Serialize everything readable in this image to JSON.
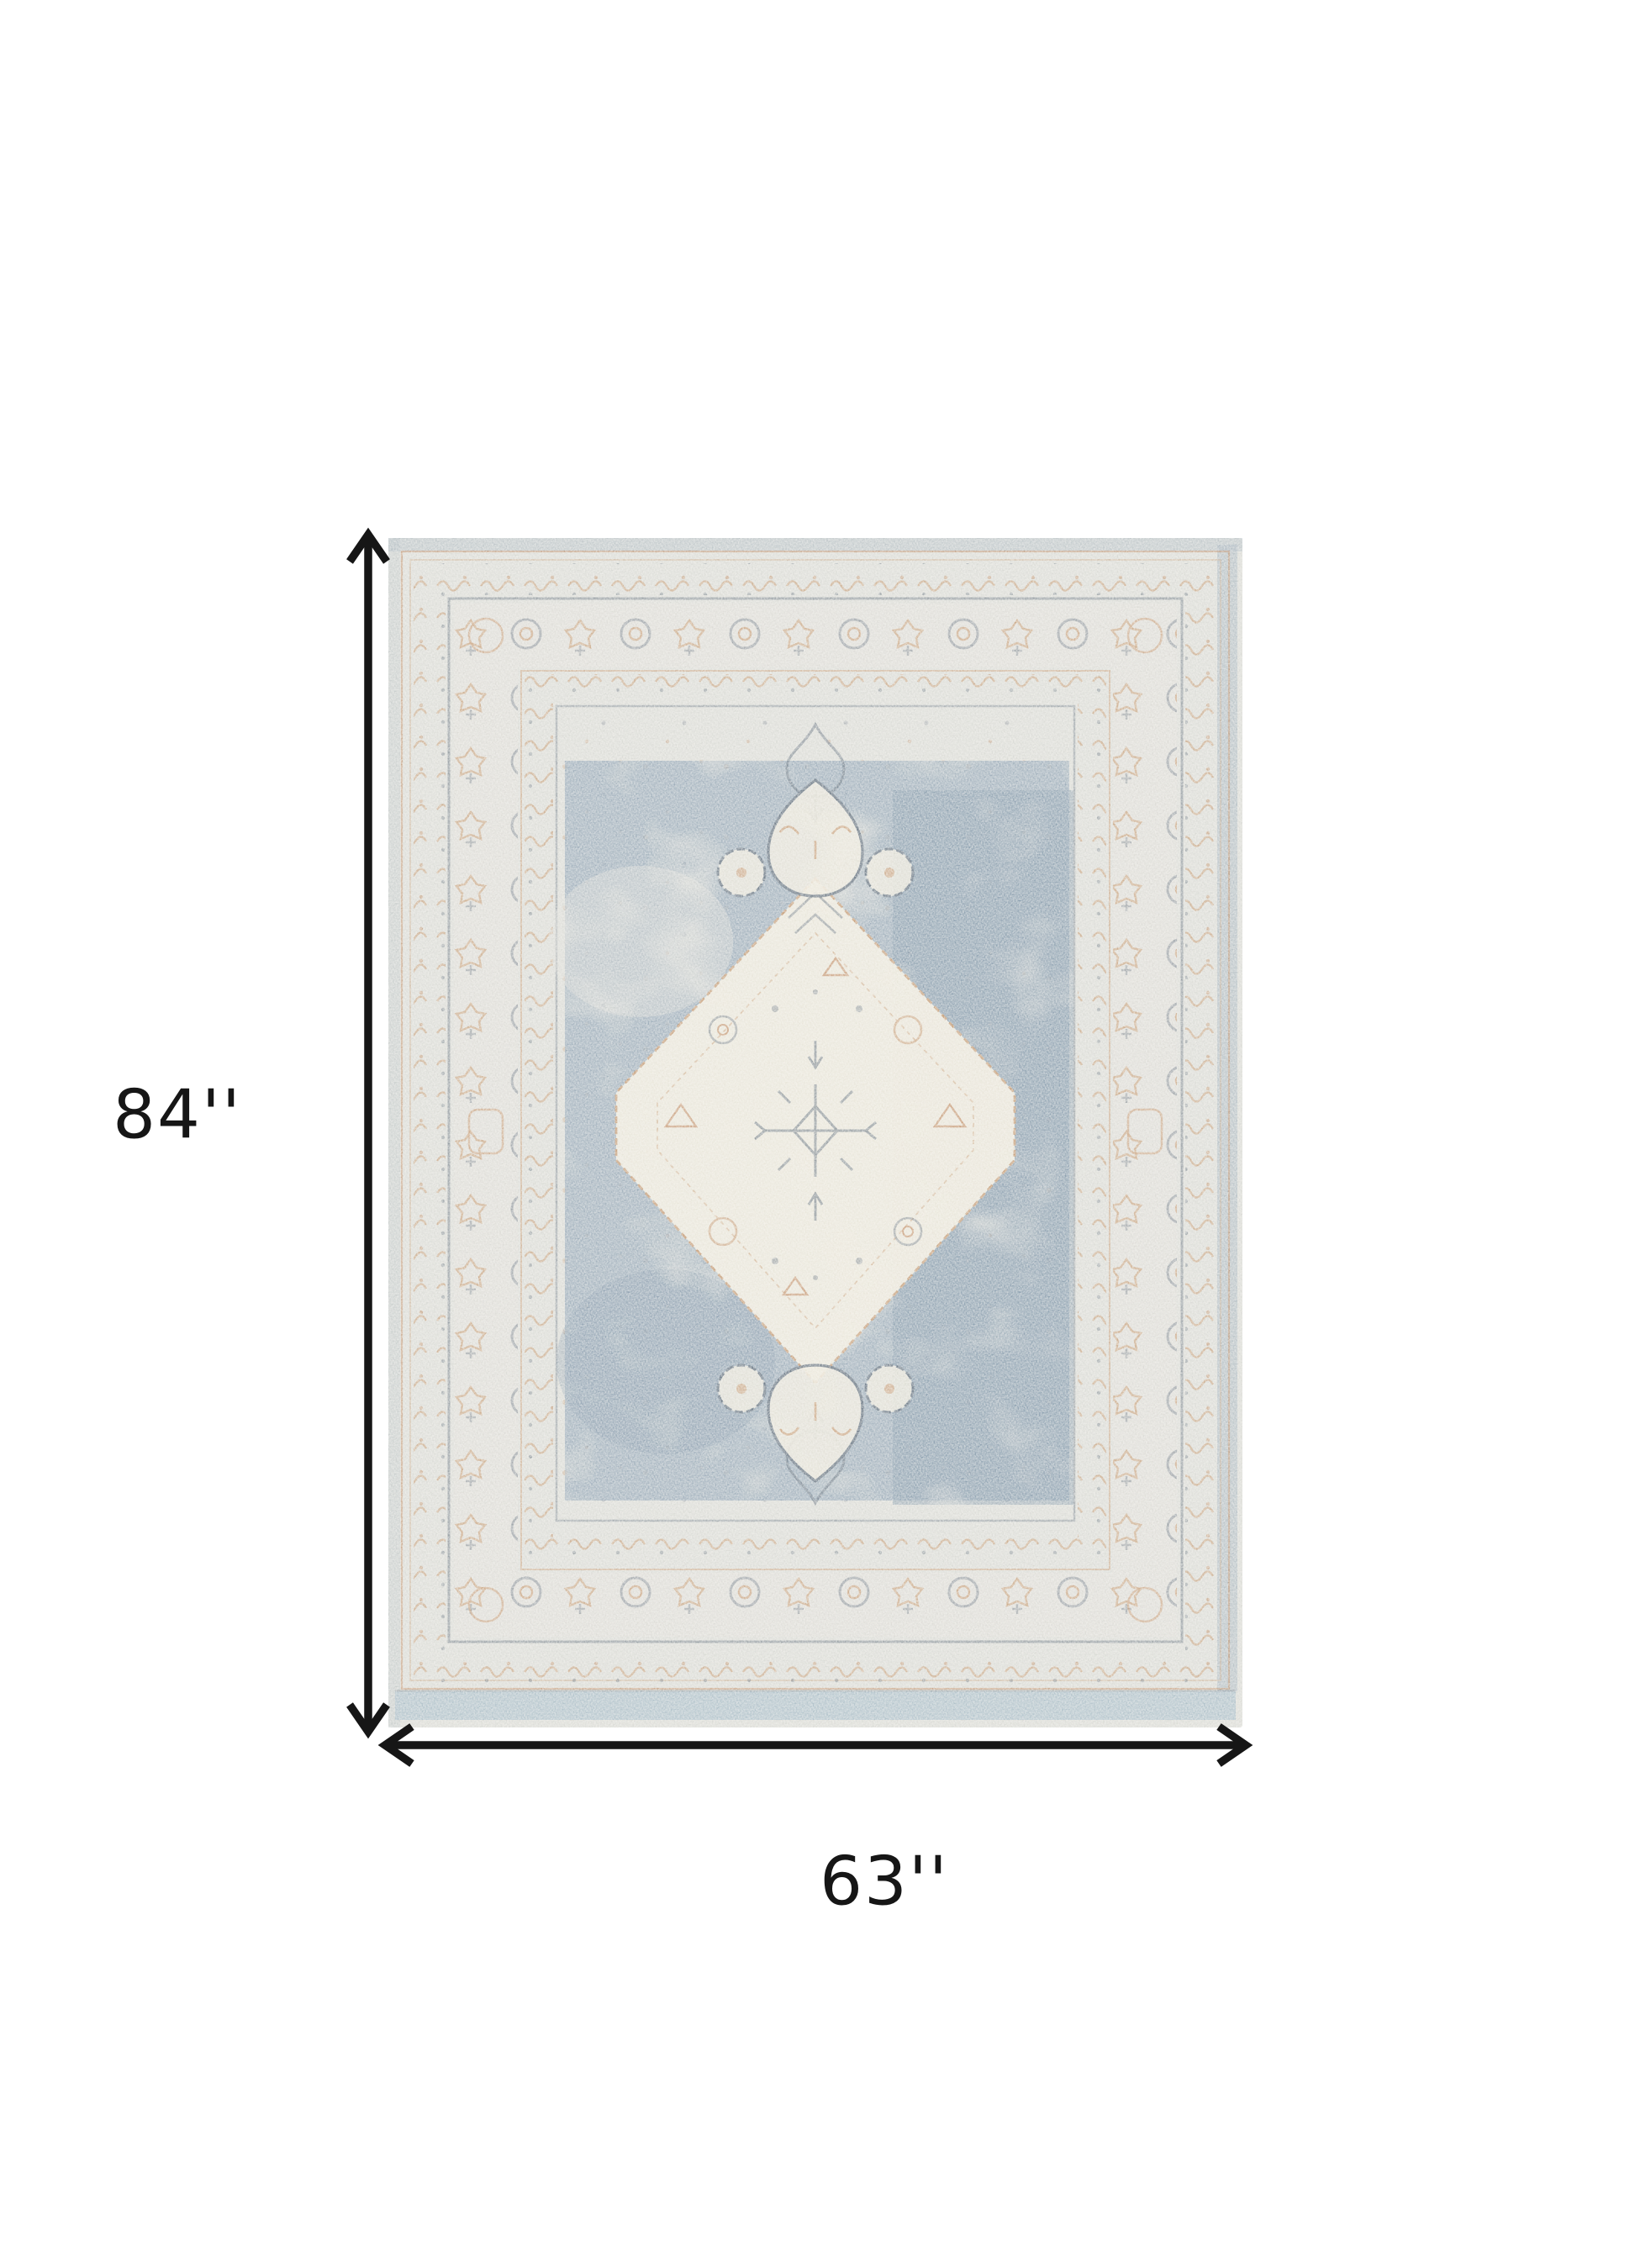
{
  "page": {
    "background": "#ffffff",
    "description": "Product dimension diagram of a distressed vintage-style oriental area rug with a cream center medallion on a blue-gray field"
  },
  "product_diagram": {
    "height_label": "84''",
    "width_label": "63''"
  },
  "colors": {
    "page-bg": "#ffffff",
    "annotation-ink": "#161616",
    "rug-base": "#d9dad5",
    "rug-border-bg": "#dddcd6",
    "rug-field-blue": "#8fa3b4",
    "rug-field-blue-dark": "#7e94a7",
    "rug-medallion-cream": "#ebe7da",
    "rug-accent-tan": "#c49a73",
    "rug-accent-rust": "#b97f52",
    "rug-motif-slate": "#5d6b79",
    "rug-edge-blue": "#a9bcc8",
    "rug-edge-slate": "#93a5b5"
  }
}
